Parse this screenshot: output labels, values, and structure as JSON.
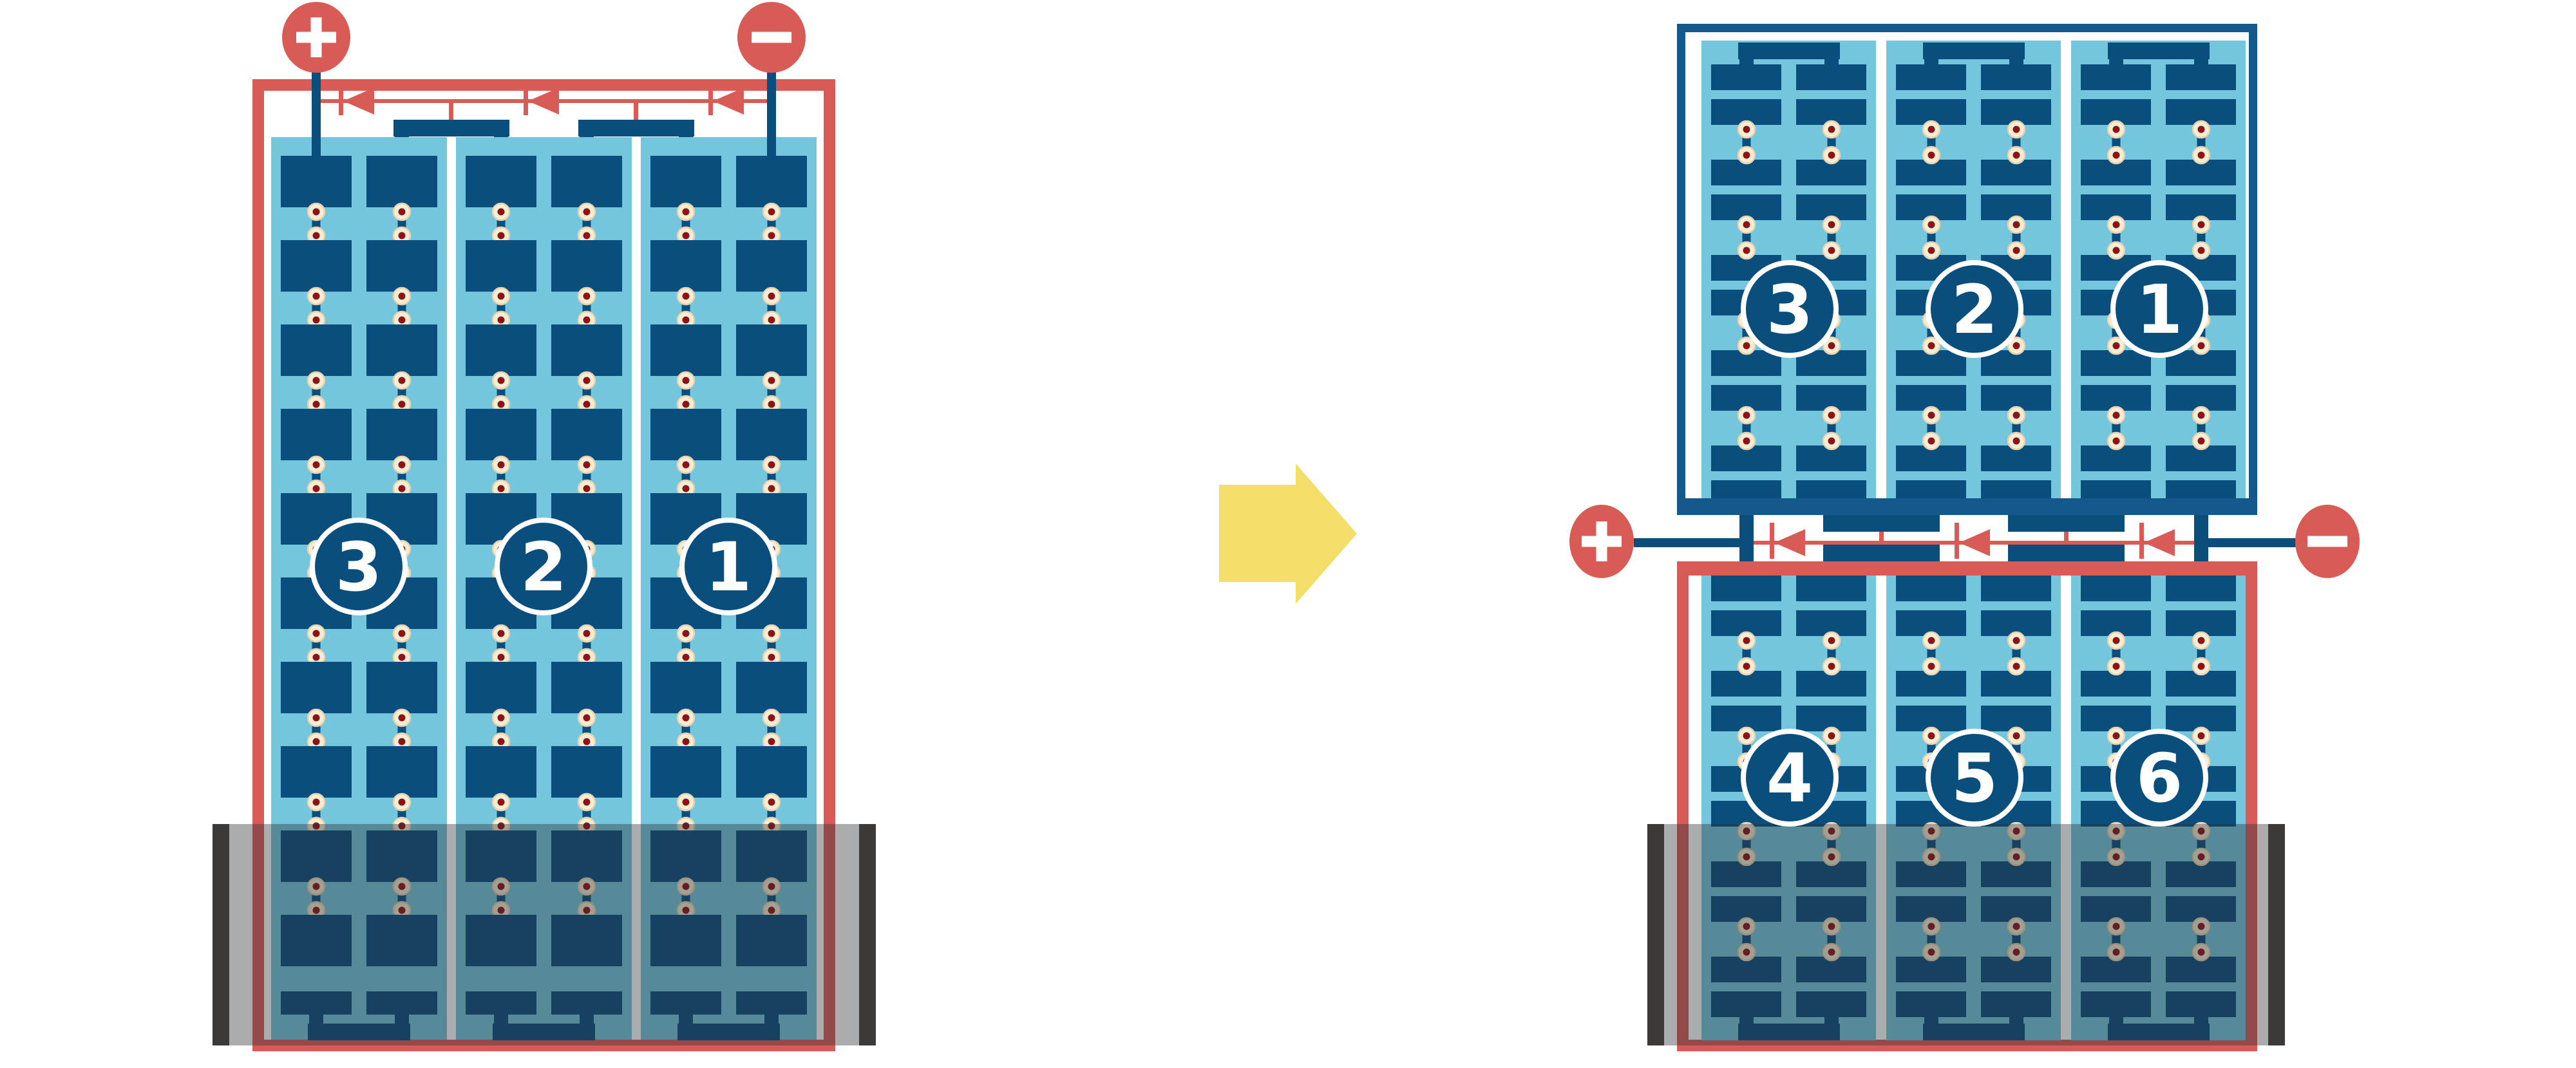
{
  "figure": {
    "kind": "solar-module-reconfiguration-diagram",
    "left_module": {
      "strings": [
        "3",
        "2",
        "1"
      ],
      "terminals": [
        {
          "polarity": "+",
          "position": "top-left"
        },
        {
          "polarity": "−",
          "position": "top-right"
        }
      ],
      "partially_submerged": true
    },
    "right_modules": {
      "top": {
        "strings": [
          "3",
          "2",
          "1"
        ],
        "frame": "blue",
        "submerged": false
      },
      "bottom": {
        "strings": [
          "4",
          "5",
          "6"
        ],
        "frame": "red",
        "partially_submerged": true
      },
      "terminals": [
        {
          "polarity": "+",
          "position": "middle-left"
        },
        {
          "polarity": "−",
          "position": "middle-right"
        }
      ]
    }
  },
  "colors": {
    "background": "#FFFFFF",
    "red": "#D85B55",
    "light_blue": "#73C6DC",
    "cell_blue": "#0A4E7D",
    "frame_blue": "#14598B",
    "dot_cream": "#F7ECD4",
    "dot_ring": "#E6D2AE",
    "dot_red": "#8C1413",
    "water_overlay": "rgba(42,48,52,0.40)",
    "water_edge_gray": "#3B3A39",
    "arrow_yellow": "#F2DE69",
    "white": "#FFFFFF"
  }
}
